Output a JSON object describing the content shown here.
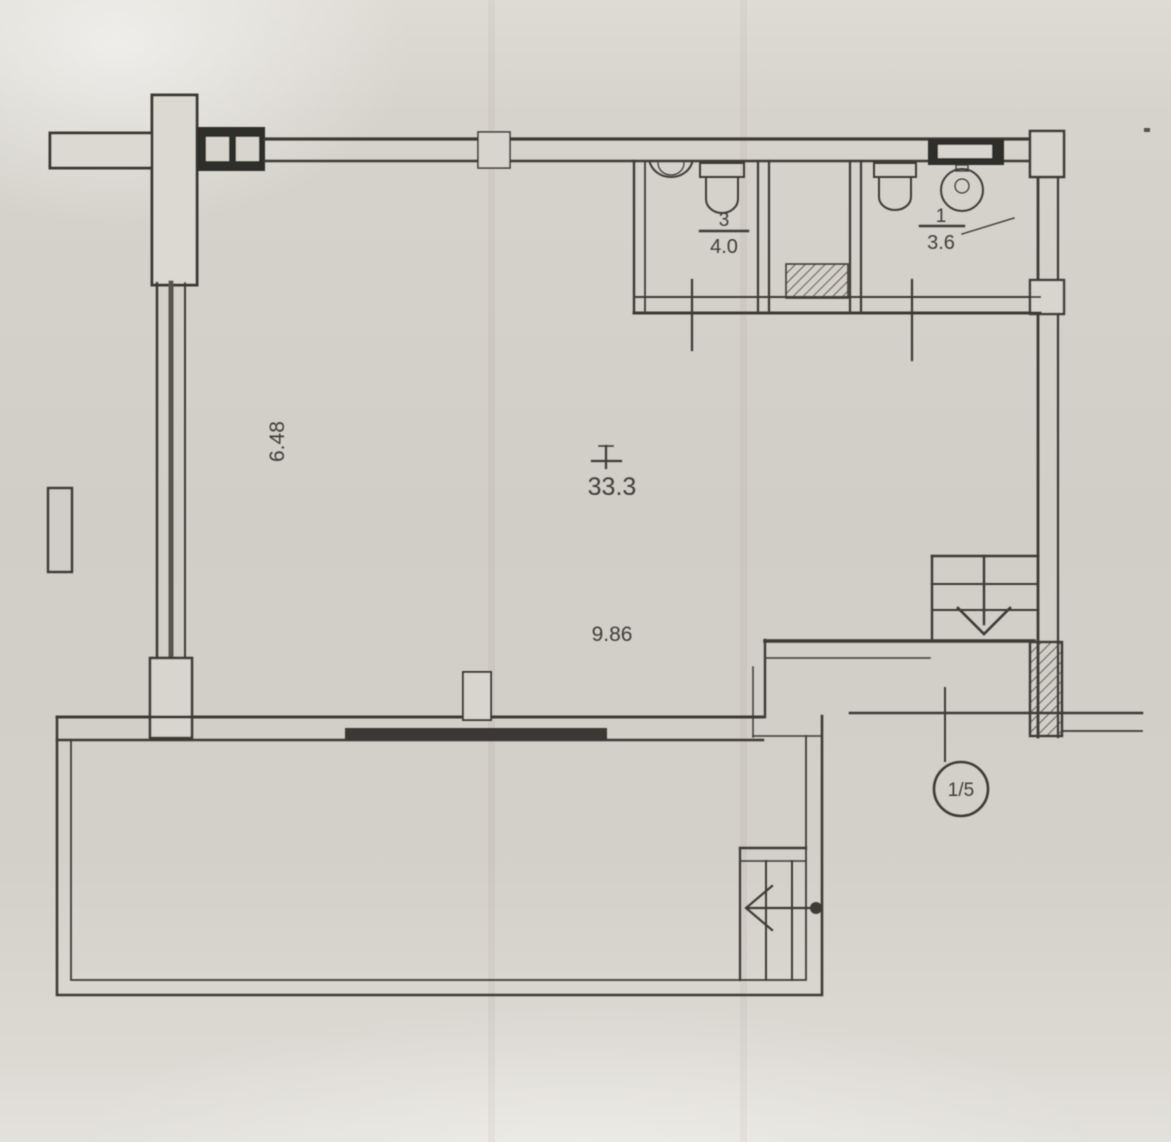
{
  "plan": {
    "main_room": {
      "area": "33.3",
      "dim_vertical": "6.48",
      "dim_horizontal": "9.86"
    },
    "bathroom_left": {
      "number": "3",
      "area": "4.0"
    },
    "bathroom_right": {
      "number": "1",
      "area": "3.6"
    },
    "section_marker": "1/5"
  },
  "colors": {
    "paper": "#d5d2cb",
    "ink": "#3e3b36",
    "fill_dark": "#2f2d2a"
  }
}
